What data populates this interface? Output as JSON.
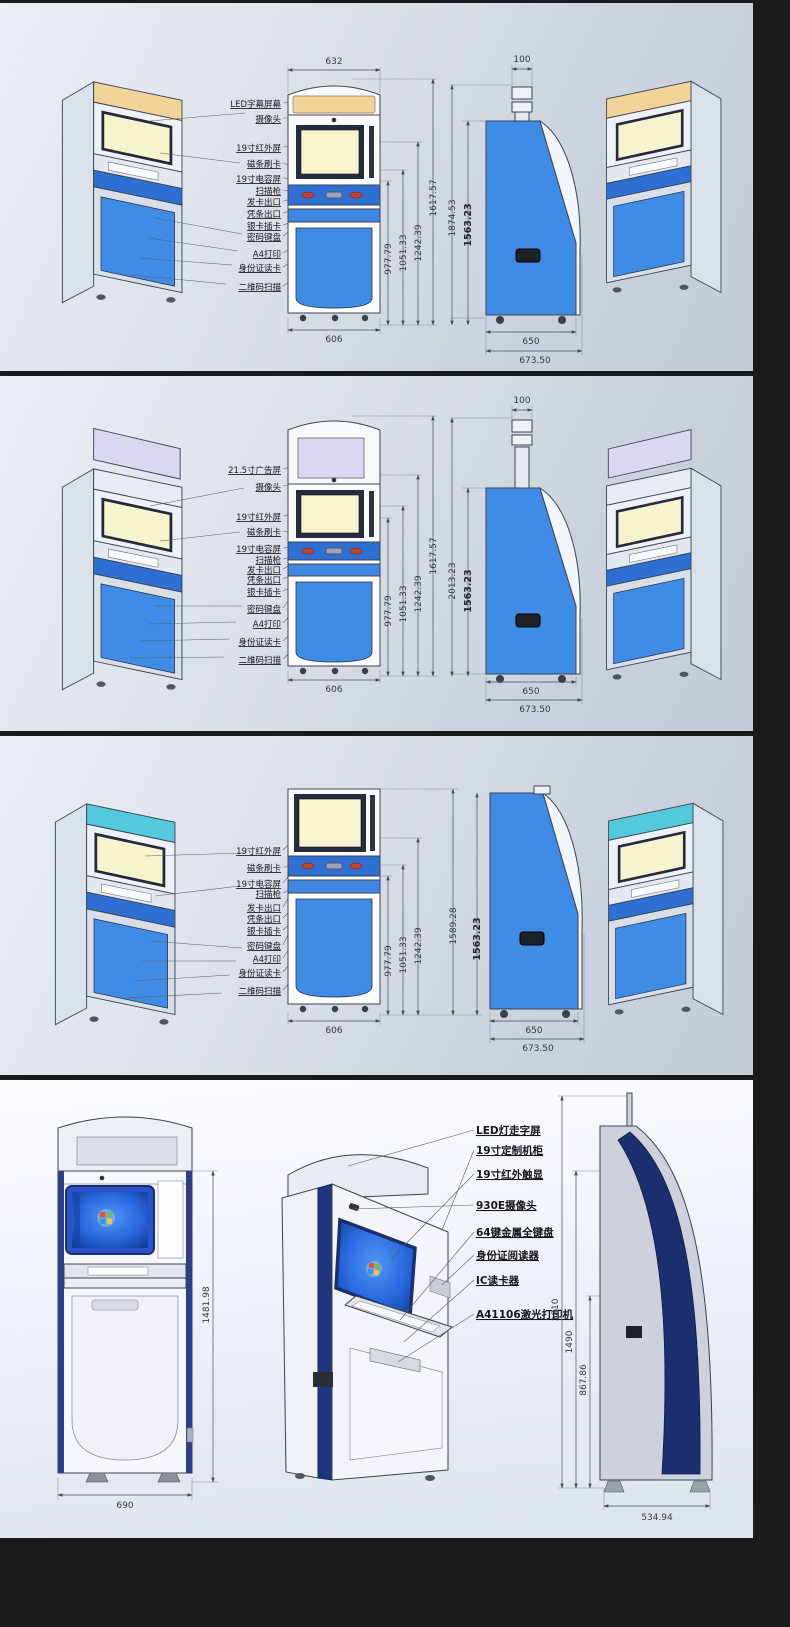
{
  "document": {
    "type": "kiosk-engineering-drawing",
    "colors": {
      "page_bg": "#1a1a1a",
      "panel_bg": "#d8dde6",
      "machine_blue": "#3e8ce6",
      "band_blue": "#2e6fd4",
      "navy_trim": "#1b2f6e",
      "screen_cream": "#f8f4d0",
      "led_amber": "#efd398",
      "ad_lavender": "#d9d7f2",
      "teal_top": "#52cadc",
      "windows_blue": "#2a6ae0"
    }
  },
  "panels": [
    {
      "labels": [
        "LED字幕屏幕",
        "摄像头",
        "19寸红外屏",
        "磁条刷卡",
        "19寸电容屏",
        "扫描枪",
        "发卡出口",
        "凭条出口",
        "银卡插卡",
        "密码键盘",
        "A4打印",
        "身份证读卡",
        "二维码扫描"
      ],
      "dims": {
        "top_width": "632",
        "pole_width": "100",
        "front_height": "1617.57",
        "h1": "977.79",
        "h2": "1051.33",
        "h3": "1242.39",
        "side_total": "1874.53",
        "side_cabinet": "1563.23",
        "front_width": "606",
        "side_depth": "650",
        "side_depth_total": "673.50"
      }
    },
    {
      "labels": [
        "21.5寸广告屏",
        "摄像头",
        "19寸红外屏",
        "磁条刷卡",
        "19寸电容屏",
        "扫描枪",
        "发卡出口",
        "凭条出口",
        "银卡插卡",
        "密码键盘",
        "A4打印",
        "身份证读卡",
        "二维码扫描"
      ],
      "dims": {
        "pole_width": "100",
        "front_height": "1617.57",
        "h1": "977.79",
        "h2": "1051.33",
        "h3": "1242.39",
        "side_total": "2013.23",
        "side_cabinet": "1563.23",
        "front_width": "606",
        "side_depth": "650",
        "side_depth_total": "673.50"
      }
    },
    {
      "labels": [
        "19寸红外屏",
        "磁条刷卡",
        "19寸电容屏",
        "扫描枪",
        "发卡出口",
        "凭条出口",
        "银卡插卡",
        "密码键盘",
        "A4打印",
        "身份证读卡",
        "二维码扫描"
      ],
      "dims": {
        "h1": "977.79",
        "h2": "1051.33",
        "h3": "1242.39",
        "side_total": "1589.28",
        "side_cabinet": "1563.23",
        "front_width": "606",
        "side_depth": "650",
        "side_depth_total": "673.50"
      }
    },
    {
      "labels": [
        "LED灯走字屏",
        "19寸定制机柜",
        "19寸红外触显",
        "930E摄像头",
        "64键金属全键盘",
        "身份证阅读器",
        "IC读卡器",
        "A41106激光打印机"
      ],
      "dims": {
        "front_height": "1481.98",
        "front_width": "690",
        "side_total": "1810",
        "side_height": "1490",
        "side_lower": "867.86",
        "side_depth": "534.94"
      }
    }
  ]
}
